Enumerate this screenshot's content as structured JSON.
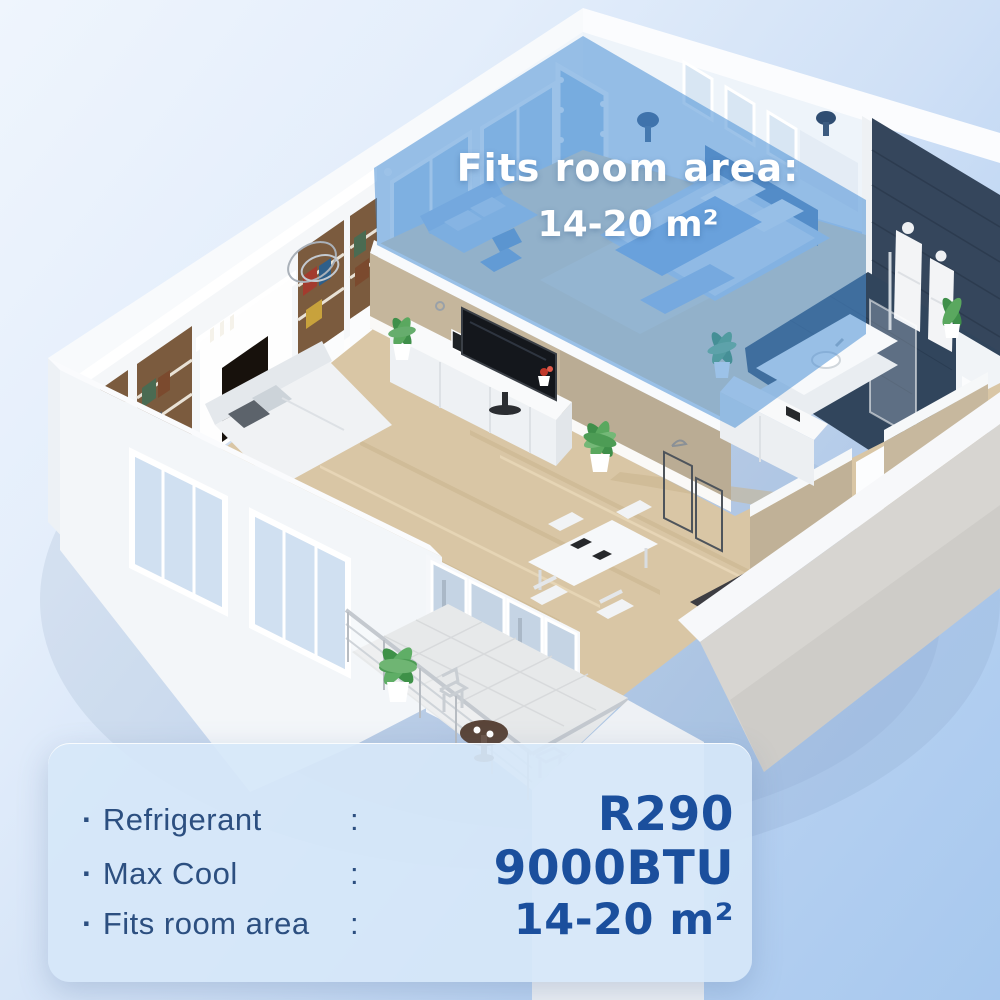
{
  "overlay": {
    "line1": "Fits room area:",
    "line2": "14-20 m²"
  },
  "panel": {
    "bullet": "·",
    "rows": [
      {
        "label": "Refrigerant",
        "colon": ":",
        "value": "R290"
      },
      {
        "label": "Max Cool",
        "colon": ":",
        "value": "9000BTU"
      },
      {
        "label": "Fits room area",
        "colon": ":",
        "value": "14-20 m²"
      }
    ]
  },
  "colors": {
    "highlight_blue": "#4a90d6",
    "panel_background": "#d6e7f9",
    "label_text": "#2c4f80",
    "value_text": "#1b4f9d",
    "overlay_text": "#ffffff"
  }
}
